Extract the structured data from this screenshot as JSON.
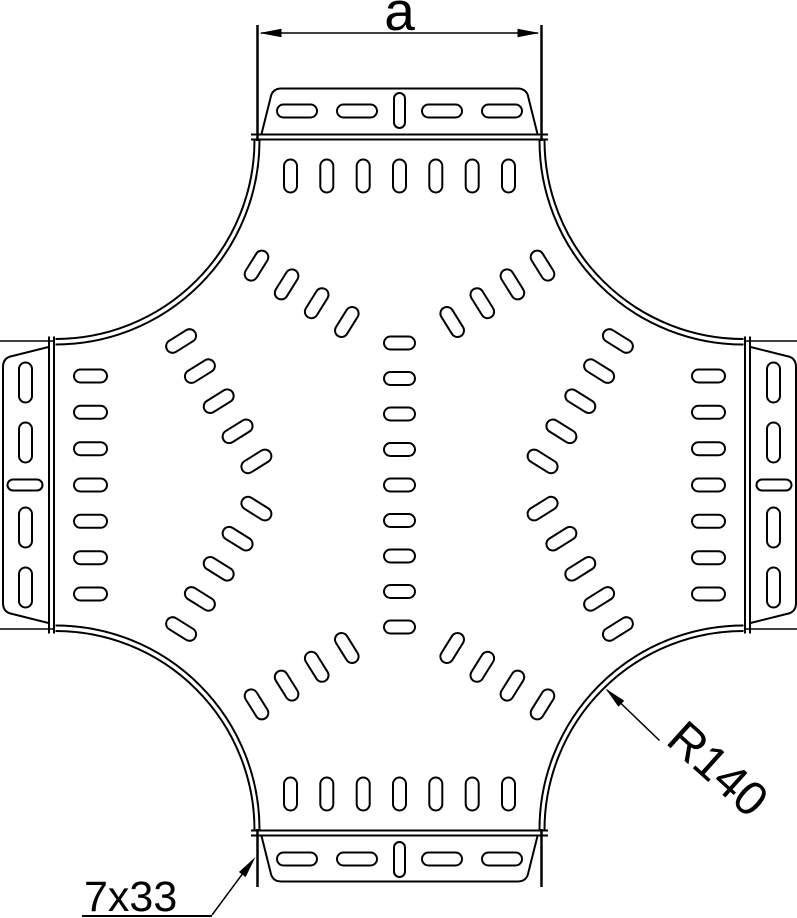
{
  "drawing": {
    "dimension_label": "a",
    "radius_label": "R140",
    "slot_size_label": "7x33"
  },
  "colors": {
    "line": "#000000",
    "background": "#ffffff"
  }
}
